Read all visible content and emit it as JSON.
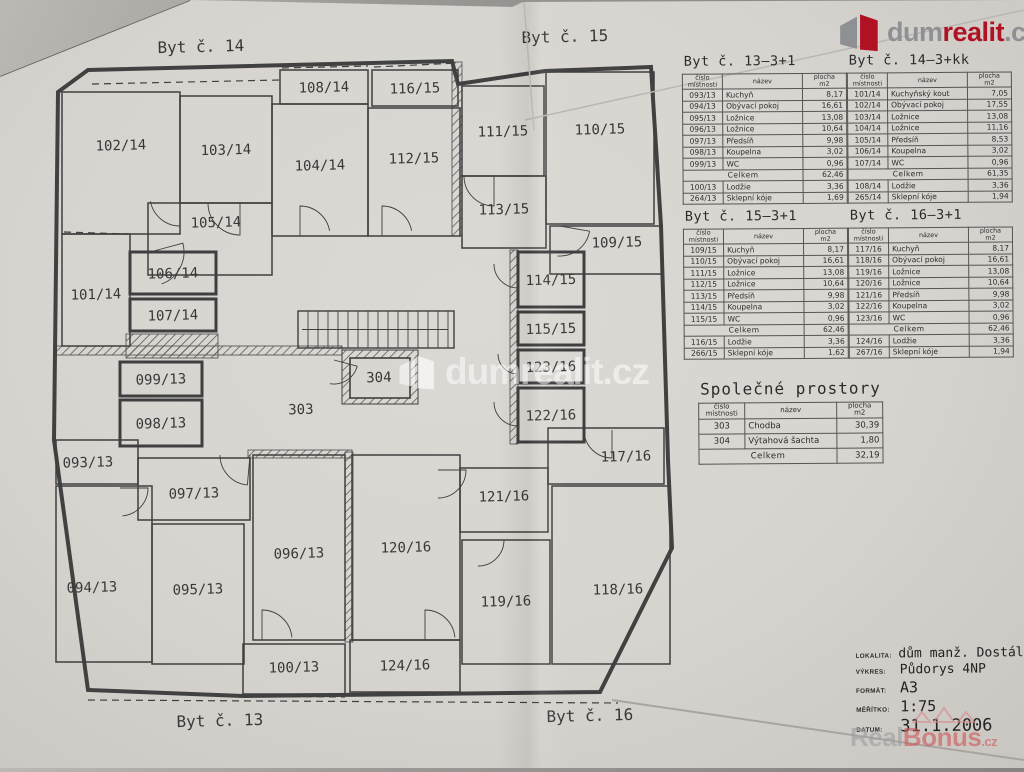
{
  "logo": {
    "text_pre": "dum",
    "text_accent": "realit",
    "text_suffix": ".cz",
    "color_red": "#b01224",
    "color_gray": "#8f9093"
  },
  "watermark_center": {
    "text": "dumrealit.cz"
  },
  "watermark_bottom": {
    "pre": "Real",
    "accent": "Bonus",
    "suffix": ".cz"
  },
  "plan": {
    "apartment_labels": [
      {
        "t": "Byt č. 14",
        "x": 201,
        "y": 52
      },
      {
        "t": "Byt č. 15",
        "x": 565,
        "y": 42
      },
      {
        "t": "Byt č. 13",
        "x": 220,
        "y": 726
      },
      {
        "t": "Byt č. 16",
        "x": 590,
        "y": 721
      }
    ],
    "outline": "88,70 452,61 458,84 545,71 651,67 661,226 668,460 672,548 600,692 243,696 88,690 54,440 58,92",
    "rooms": [
      {
        "id": "102/14",
        "x": 62,
        "y": 92,
        "w": 118,
        "h": 142,
        "ly": 150
      },
      {
        "id": "103/14",
        "x": 180,
        "y": 96,
        "w": 92,
        "h": 107
      },
      {
        "id": "104/14",
        "x": 272,
        "y": 104,
        "w": 96,
        "h": 132,
        "ly": 170
      },
      {
        "id": "108/14",
        "x": 280,
        "y": 70,
        "w": 88,
        "h": 34
      },
      {
        "id": "116/15",
        "x": 372,
        "y": 70,
        "w": 86,
        "h": 36
      },
      {
        "id": "112/15",
        "x": 368,
        "y": 108,
        "w": 92,
        "h": 128,
        "ly": 163
      },
      {
        "id": "111/15",
        "x": 462,
        "y": 86,
        "w": 82,
        "h": 90
      },
      {
        "id": "110/15",
        "x": 546,
        "y": 72,
        "w": 108,
        "h": 152,
        "ly": 134
      },
      {
        "id": "113/15",
        "x": 462,
        "y": 176,
        "w": 84,
        "h": 72,
        "ly": 214
      },
      {
        "id": "109/15",
        "x": 550,
        "y": 226,
        "w": 112,
        "h": 48,
        "lx": 617,
        "ly": 247
      },
      {
        "id": "105/14",
        "x": 148,
        "y": 203,
        "w": 124,
        "h": 72,
        "lx": 216,
        "ly": 227
      },
      {
        "id": "101/14",
        "x": 62,
        "y": 234,
        "w": 68,
        "h": 112,
        "ly": 299
      },
      {
        "id": "106/14",
        "x": 130,
        "y": 252,
        "w": 86,
        "h": 42,
        "b": 1
      },
      {
        "id": "107/14",
        "x": 130,
        "y": 299,
        "w": 86,
        "h": 32,
        "b": 1
      },
      {
        "id": "114/15",
        "x": 518,
        "y": 252,
        "w": 66,
        "h": 55,
        "b": 1
      },
      {
        "id": "115/15",
        "x": 518,
        "y": 312,
        "w": 66,
        "h": 33,
        "b": 1
      },
      {
        "id": "123/16",
        "x": 518,
        "y": 350,
        "w": 66,
        "h": 33,
        "b": 1
      },
      {
        "id": "122/16",
        "x": 518,
        "y": 388,
        "w": 66,
        "h": 54,
        "b": 1
      },
      {
        "id": "099/13",
        "x": 120,
        "y": 362,
        "w": 82,
        "h": 34,
        "b": 1
      },
      {
        "id": "098/13",
        "x": 120,
        "y": 400,
        "w": 82,
        "h": 46,
        "b": 1
      },
      {
        "id": "093/13",
        "x": 56,
        "y": 440,
        "w": 82,
        "h": 44,
        "lx": 88
      },
      {
        "id": "097/13",
        "x": 138,
        "y": 458,
        "w": 112,
        "h": 62,
        "ly": 498
      },
      {
        "id": "094/13",
        "x": 56,
        "y": 486,
        "w": 96,
        "h": 176,
        "lx": 92,
        "ly": 592
      },
      {
        "id": "095/13",
        "x": 152,
        "y": 524,
        "w": 92,
        "h": 140,
        "ly": 594
      },
      {
        "id": "096/13",
        "x": 253,
        "y": 455,
        "w": 92,
        "h": 185,
        "ly": 558
      },
      {
        "id": "100/13",
        "x": 243,
        "y": 644,
        "w": 102,
        "h": 50,
        "ly": 672
      },
      {
        "id": "120/16",
        "x": 352,
        "y": 455,
        "w": 108,
        "h": 185,
        "ly": 552
      },
      {
        "id": "121/16",
        "x": 460,
        "y": 468,
        "w": 88,
        "h": 64,
        "ly": 501
      },
      {
        "id": "117/16",
        "x": 548,
        "y": 428,
        "w": 116,
        "h": 56,
        "lx": 626,
        "ly": 461
      },
      {
        "id": "119/16",
        "x": 462,
        "y": 540,
        "w": 88,
        "h": 124,
        "ly": 606
      },
      {
        "id": "118/16",
        "x": 552,
        "y": 486,
        "w": 118,
        "h": 178,
        "lx": 618,
        "ly": 594
      },
      {
        "id": "124/16",
        "x": 350,
        "y": 640,
        "w": 110,
        "h": 52,
        "ly": 670
      }
    ],
    "free_labels": [
      {
        "t": "303",
        "x": 301,
        "y": 414
      },
      {
        "t": "304",
        "x": 379,
        "y": 382
      }
    ],
    "hatch_walls": [
      [
        452,
        62,
        10,
        174
      ],
      [
        56,
        346,
        286,
        9
      ],
      [
        126,
        334,
        92,
        24
      ],
      [
        510,
        250,
        8,
        194
      ],
      [
        345,
        452,
        8,
        190
      ],
      [
        248,
        450,
        104,
        8
      ]
    ],
    "elevator": {
      "outer": [
        342,
        350,
        76,
        54
      ],
      "inner": [
        350,
        358,
        60,
        40
      ]
    },
    "stairs": {
      "x": 298,
      "y": 311,
      "w": 156,
      "h": 37,
      "step": 10
    },
    "dashed_lines": [
      [
        282,
        68,
        368,
        66
      ],
      [
        374,
        67,
        458,
        63
      ],
      [
        92,
        84,
        280,
        80
      ],
      [
        64,
        232,
        128,
        234
      ],
      [
        88,
        700,
        618,
        703
      ],
      [
        245,
        696,
        345,
        697
      ],
      [
        352,
        694,
        458,
        692
      ]
    ],
    "doors": [
      [
        240,
        203,
        32,
        90,
        180
      ],
      [
        180,
        196,
        30,
        90,
        170
      ],
      [
        300,
        236,
        30,
        270,
        350
      ],
      [
        382,
        236,
        30,
        270,
        350
      ],
      [
        494,
        176,
        30,
        90,
        180
      ],
      [
        560,
        226,
        30,
        10,
        95
      ],
      [
        518,
        264,
        24,
        90,
        180
      ],
      [
        518,
        354,
        20,
        90,
        180
      ],
      [
        518,
        402,
        24,
        90,
        180
      ],
      [
        334,
        360,
        24,
        15,
        100
      ],
      [
        612,
        430,
        28,
        90,
        175
      ],
      [
        438,
        470,
        28,
        0,
        90
      ],
      [
        478,
        540,
        26,
        0,
        90
      ],
      [
        120,
        488,
        28,
        0,
        85
      ],
      [
        262,
        640,
        30,
        270,
        355
      ],
      [
        425,
        640,
        30,
        270,
        355
      ],
      [
        250,
        455,
        30,
        95,
        180
      ],
      [
        150,
        252,
        34,
        -15,
        70
      ]
    ]
  },
  "tables": [
    {
      "x": 684,
      "y": 55,
      "big": false,
      "title": "Byt č. 13–3+1",
      "headers": [
        "číslo\nmístnosti",
        "název",
        "plocha\nm2"
      ],
      "rows": [
        [
          "093/13",
          "Kuchyň",
          "8,17"
        ],
        [
          "094/13",
          "Obývací pokoj",
          "16,61"
        ],
        [
          "095/13",
          "Ložnice",
          "13,08"
        ],
        [
          "096/13",
          "Ložnice",
          "10,64"
        ],
        [
          "097/13",
          "Předsíň",
          "9,98"
        ],
        [
          "098/13",
          "Koupelna",
          "3,02"
        ],
        [
          "099/13",
          "WC",
          "0,96"
        ]
      ],
      "total_label": "Celkem",
      "total_value": "62,46",
      "extra_rows": [
        [
          "100/13",
          "Lodžie",
          "3,36"
        ],
        [
          "264/13",
          "Sklepní kóje",
          "1,69"
        ]
      ]
    },
    {
      "x": 849,
      "y": 55,
      "big": false,
      "title": "Byt č. 14–3+kk",
      "headers": [
        "číslo\nmístnosti",
        "název",
        "plocha\nm2"
      ],
      "rows": [
        [
          "101/14",
          "Kuchyňský kout",
          "7,05"
        ],
        [
          "102/14",
          "Obývací pokoj",
          "17,55"
        ],
        [
          "103/14",
          "Ložnice",
          "13,08"
        ],
        [
          "104/14",
          "Ložnice",
          "11,16"
        ],
        [
          "105/14",
          "Předsíň",
          "8,53"
        ],
        [
          "106/14",
          "Koupelna",
          "3,02"
        ],
        [
          "107/14",
          "WC",
          "0,96"
        ]
      ],
      "total_label": "Celkem",
      "total_value": "61,35",
      "extra_rows": [
        [
          "108/14",
          "Lodžie",
          "3,36"
        ],
        [
          "265/14",
          "Sklepní kóje",
          "1,94"
        ]
      ]
    },
    {
      "x": 684,
      "y": 210,
      "big": false,
      "title": "Byt č. 15–3+1",
      "headers": [
        "číslo\nmístnosti",
        "název",
        "plocha\nm2"
      ],
      "rows": [
        [
          "109/15",
          "Kuchyň",
          "8,17"
        ],
        [
          "110/15",
          "Obývací pokoj",
          "16,61"
        ],
        [
          "111/15",
          "Ložnice",
          "13,08"
        ],
        [
          "112/15",
          "Ložnice",
          "10,64"
        ],
        [
          "113/15",
          "Předsíň",
          "9,98"
        ],
        [
          "114/15",
          "Koupelna",
          "3,02"
        ],
        [
          "115/15",
          "WC",
          "0,96"
        ]
      ],
      "total_label": "Celkem",
      "total_value": "62,46",
      "extra_rows": [
        [
          "116/15",
          "Lodžie",
          "3,36"
        ],
        [
          "266/15",
          "Sklepní kóje",
          "1,62"
        ]
      ]
    },
    {
      "x": 849,
      "y": 210,
      "big": false,
      "title": "Byt č. 16–3+1",
      "headers": [
        "číslo\nmístnosti",
        "název",
        "plocha\nm2"
      ],
      "rows": [
        [
          "117/16",
          "Kuchyň",
          "8,17"
        ],
        [
          "118/16",
          "Obývací pokoj",
          "16,61"
        ],
        [
          "119/16",
          "Ložnice",
          "13,08"
        ],
        [
          "120/16",
          "Ložnice",
          "10,64"
        ],
        [
          "121/16",
          "Předsíň",
          "9,98"
        ],
        [
          "122/16",
          "Koupelna",
          "3,02"
        ],
        [
          "123/16",
          "WC",
          "0,96"
        ]
      ],
      "total_label": "Celkem",
      "total_value": "62,46",
      "extra_rows": [
        [
          "124/16",
          "Lodžie",
          "3,36"
        ],
        [
          "267/16",
          "Sklepní kóje",
          "1,94"
        ]
      ]
    },
    {
      "x": 698,
      "y": 381,
      "big": true,
      "title": "Společné prostory",
      "headers": [
        "číslo\nmístnosti",
        "název",
        "plocha\nm2"
      ],
      "rows": [
        [
          "303",
          "Chodba",
          "30,39"
        ],
        [
          "304",
          "Výtahová šachta",
          "1,80"
        ]
      ],
      "total_label": "Celkem",
      "total_value": "32,19",
      "extra_rows": []
    }
  ],
  "title_block": {
    "rows": [
      {
        "label": "LOKALITA:",
        "value": "dům manž. Dostál"
      },
      {
        "label": "VÝKRES:",
        "value": "Půdorys 4NP"
      },
      {
        "label": "FORMÁT:",
        "value": "A3"
      },
      {
        "label": "MĚŘÍTKO:",
        "value": "1:75"
      },
      {
        "label": "DATUM:",
        "value": "31.1.2006"
      }
    ]
  }
}
